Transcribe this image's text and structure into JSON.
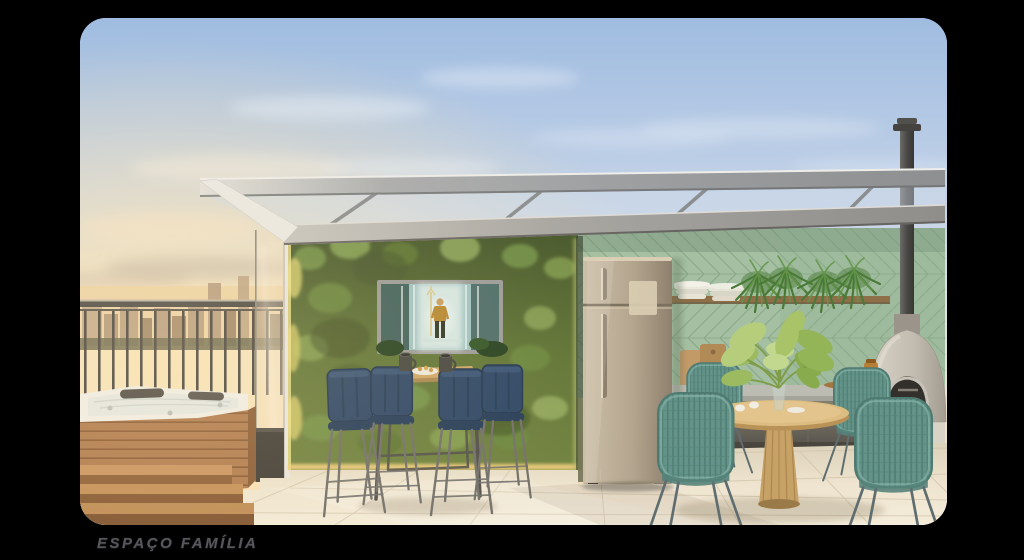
{
  "page": {
    "backdrop": "#000000"
  },
  "caption": {
    "text": "ESPAÇO FAMÍLIA"
  },
  "scene": {
    "description": "Rooftop family terrace render: jacuzzi with city sunset view, vertical garden wall with TV, bar table with navy stools, outdoor kitchen with refrigerator, green chevron tile wall, shelf with plates and ferns, pizza oven with chimney, round wooden dining table with teal rope chairs under a glass pergola",
    "tv_screen_content": "aquaman-waterfall-scene",
    "palette": {
      "backdrop": "#000000",
      "caption_text": "#58585c",
      "sky_top": "#9fbce0",
      "sky_mid": "#c6d4e8",
      "sunset_glow": "#f6dcb2",
      "pergola_beam": "#97999b",
      "pergola_white": "#ebe9e4",
      "living_wall_green": "#5d7234",
      "led_glow": "#f3cf7f",
      "tile_wall_sage": "#a5bfa2",
      "tile_line": "#7fa07e",
      "fridge_steel": "#b3a58e",
      "deck_wood": "#b07b4e",
      "table_wood": "#d8b87c",
      "stool_navy": "#2c4565",
      "chair_teal": "#649489",
      "oven_body": "#c9c2b6",
      "floor_tile": "#ece2cc",
      "railing_dark": "#45423e"
    }
  }
}
